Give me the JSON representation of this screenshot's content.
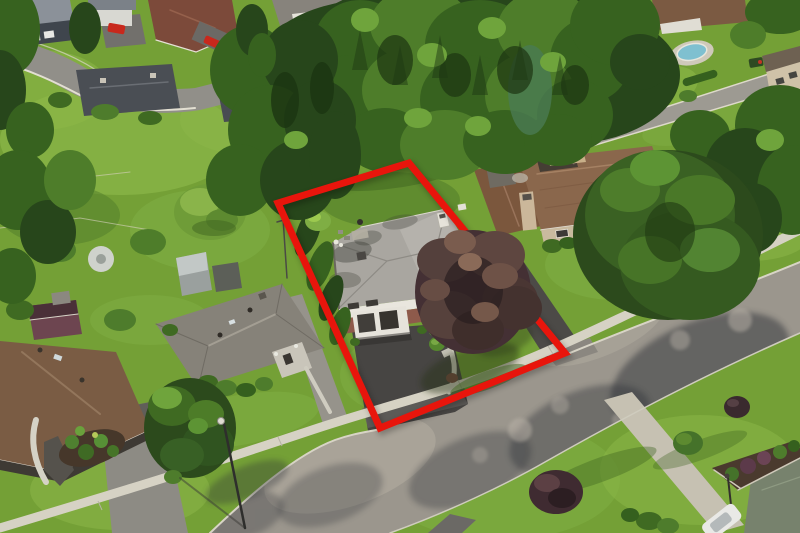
{
  "scene": {
    "type": "aerial-drone-photograph",
    "setting": "Aerial view of a suburban residential neighborhood with a red boundary outline highlighting one property",
    "landmarks": [
      "evergreen forest",
      "curving side street",
      "main street with sidewalk",
      "highlighted two-storey house with double garage",
      "large purple-leaf tree",
      "large conifer tree",
      "neighbor houses",
      "driveways",
      "street lamp",
      "parked cars"
    ]
  },
  "boundary": {
    "points": "409,163 278,203 380,428 565,353",
    "color": "#e8150c",
    "stroke_width": 7
  },
  "colors": {
    "lawn": "#74a036",
    "lawn_bright": "#8cb748",
    "lawn_dark": "#4e7326",
    "forest_dark": "#27461b",
    "forest_mid": "#37621f",
    "forest_light": "#4e7d2a",
    "street": "#9b968d",
    "street_light": "#b5aea3",
    "sidewalk": "#d6d2c4",
    "curb": "#d8d4c6",
    "driveway_dark": "#474543",
    "driveway_light": "#96938b",
    "subject_roof": "#a9a6a0",
    "subject_brick": "#8e5a4b",
    "subject_wall": "#e9e6de",
    "neighbor_roof": "#8a674c",
    "neighbor_wall": "#c9ba9f",
    "gray_roof": "#868279",
    "brown_roof": "#7a5c44",
    "purple_tree": "#443034",
    "conifer": "#2c4a1c",
    "pool_blue": "#7fc0d0",
    "car_red": "#c8281c",
    "car_white": "#e9e9e6",
    "mulch": "#46372a"
  }
}
